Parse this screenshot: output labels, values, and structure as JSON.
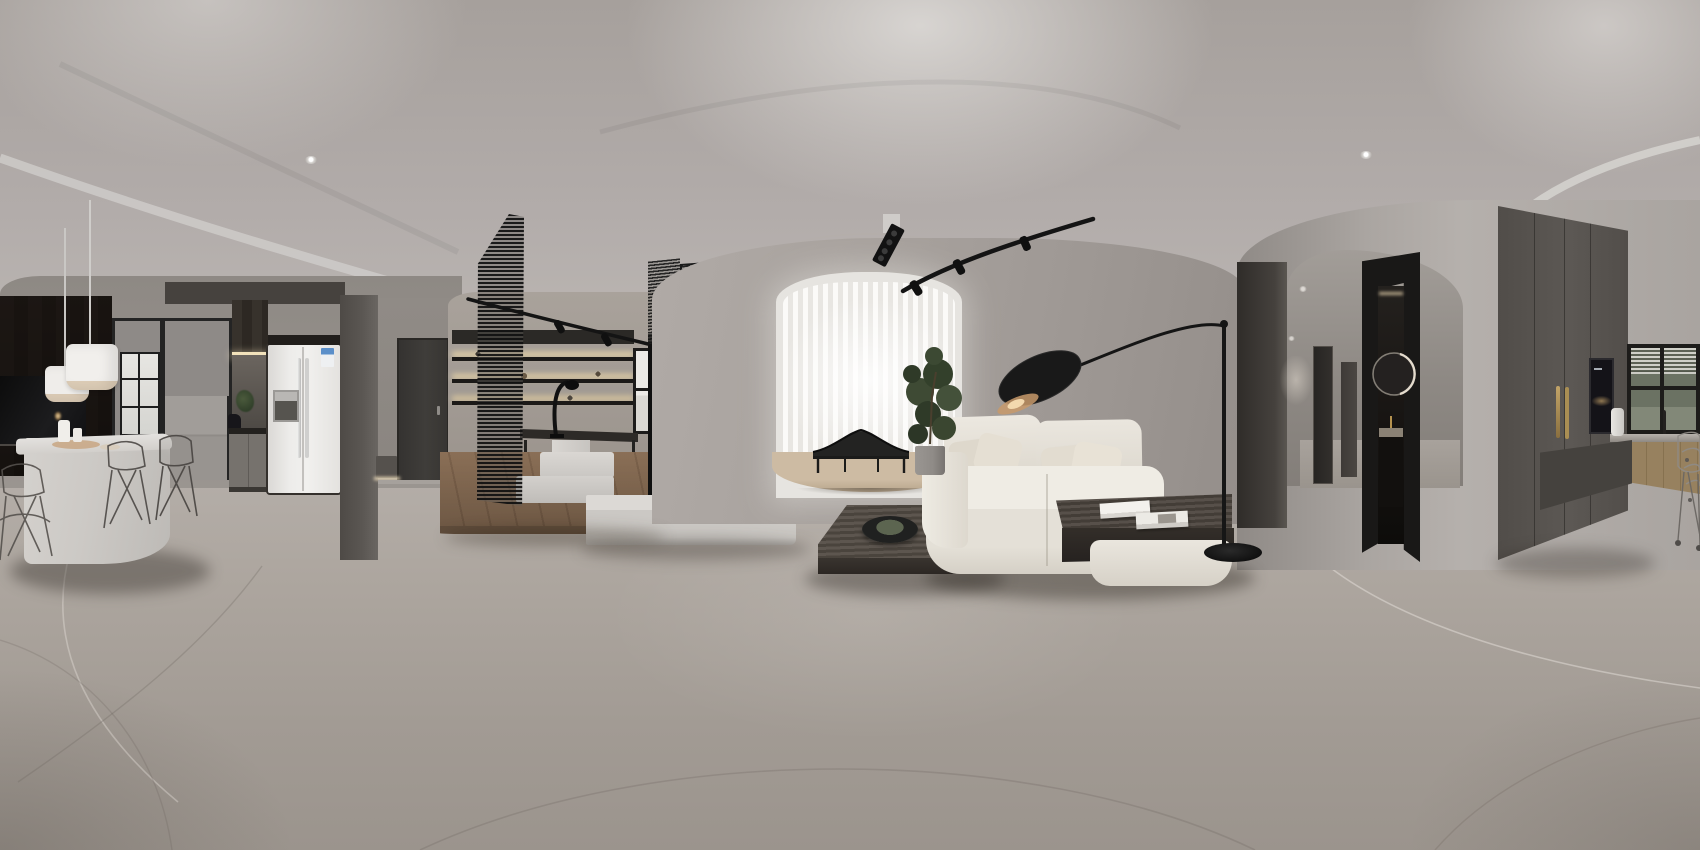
{
  "scene": {
    "type": "equirectangular-360-panorama",
    "subject": "modern minimalist apartment interior render",
    "areas": [
      "dining-kitchen-island",
      "entry-hall",
      "study-tearoom",
      "living-room",
      "window-bay",
      "hallway-bathroom",
      "second-kitchen"
    ]
  },
  "palette": {
    "ceiling": "#b3adA9",
    "ceiling_bright": "#cfccc9",
    "wall_gray": "#a39d99",
    "floor_gray": "#aaa39d",
    "dark_wood": "#3b3531",
    "cabinet_dark_gray": "#57534f",
    "fridge_white": "#eceae8",
    "sofa_white": "#e9e5dd",
    "wood_warm": "#8a7058",
    "wood_slat": "#b2906c",
    "black_fixture": "#161616",
    "led_warm": "#f0ddb0",
    "brass": "#aa8c55",
    "curtain_white": "#f6f4f1",
    "plant_green": "#3e4a34"
  },
  "objects": {
    "pendants": "white drum pendant lights over island",
    "island": "white waterfall kitchen island",
    "chairs": "wireframe dining chairs",
    "tv_left": "wall mounted TV on dark wood wall",
    "partition": "black framed glass partition",
    "fridge": "white side-by-side refrigerator with energy label",
    "kitchen": "dark kitchen cabinetry with lit backsplash",
    "entry_door": "dark entry door",
    "screen": "tall black slatted screen",
    "shelves": "black open shelving with warm LED strips",
    "desk": "study desk with black task lamp",
    "study_window": "black framed study window",
    "tv_media": "wood slat media panel on white plinth",
    "bay": "bright bay window with sheer vertical curtains",
    "daybed": "black curved daybed on wood platform",
    "plant": "potted fiddle-leaf fig",
    "coffee_table": "dark wood slab coffee table with bowl",
    "sofa": "white modular sofa with integrated wood side table",
    "books": "two white books on side table",
    "floor_lamp": "black arc floor lamp with leaf shade",
    "track": "black ceiling track spotlights",
    "linear_spot": "recessed linear multi-spot ceiling fixture",
    "hallway": "hallway with dark doors",
    "bathroom": "bathroom doorway with backlit round mirror",
    "tall_cabinets": "floor-to-ceiling gray cabinets with brass pulls",
    "ovens": "built-in stacked wall ovens",
    "kitchen_window": "kitchen window with greenery view",
    "bar_chairs": "stacked wire chairs at counter"
  }
}
